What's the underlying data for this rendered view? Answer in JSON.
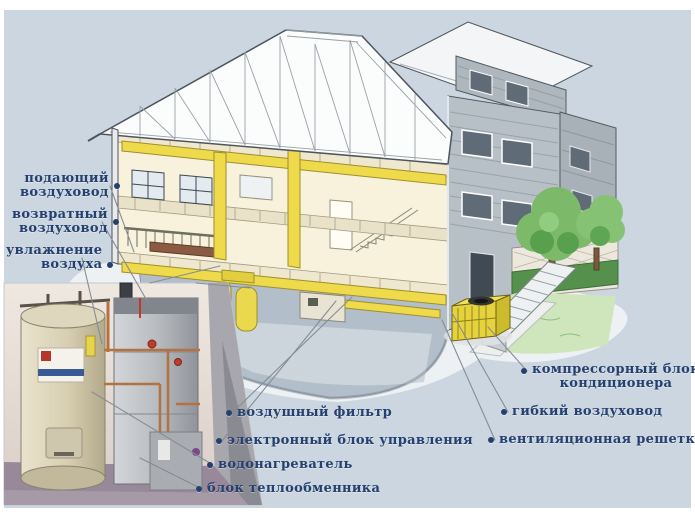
{
  "diagram": {
    "kind": "house-hvac-cutaway-diagram",
    "language": "ru"
  },
  "colors": {
    "background": "#ccd6e0",
    "frame": "#ffffff",
    "label_text": "#24406e",
    "leader_line": "#868d94",
    "duct_yellow": "#eeda4b",
    "interior_cream": "#f8f2dd",
    "siding_gray": "#b7bfc7",
    "tree_green": "#7cba6a",
    "lawn_green": "#cfe5bc",
    "brick": "#9c6a58"
  },
  "labels": {
    "left": [
      {
        "line1": "подающий",
        "line2": "воздуховод"
      },
      {
        "line1": "возвратный",
        "line2": "воздуховод"
      },
      {
        "line1": "увлажнение",
        "line2": "воздуха"
      }
    ],
    "bottom": [
      {
        "text": "воздушный фильтр"
      },
      {
        "text": "электронный блок управления"
      },
      {
        "text": "водонагреватель"
      },
      {
        "text": "блок теплообменника"
      }
    ],
    "right": [
      {
        "line1": "компрессорный блок",
        "line2": "кондиционера"
      },
      {
        "text": "гибкий воздуховод"
      },
      {
        "text": "вентиляционная решетка"
      }
    ]
  },
  "illustration_parts": {
    "house": "cutaway-house-with-yellow-ductwork",
    "photo_inset": "photo-of-water-heater-and-furnace",
    "outdoor_unit": "yellow-ac-compressor-by-stairs",
    "yard": "trees-lattice-fence-lawn"
  }
}
